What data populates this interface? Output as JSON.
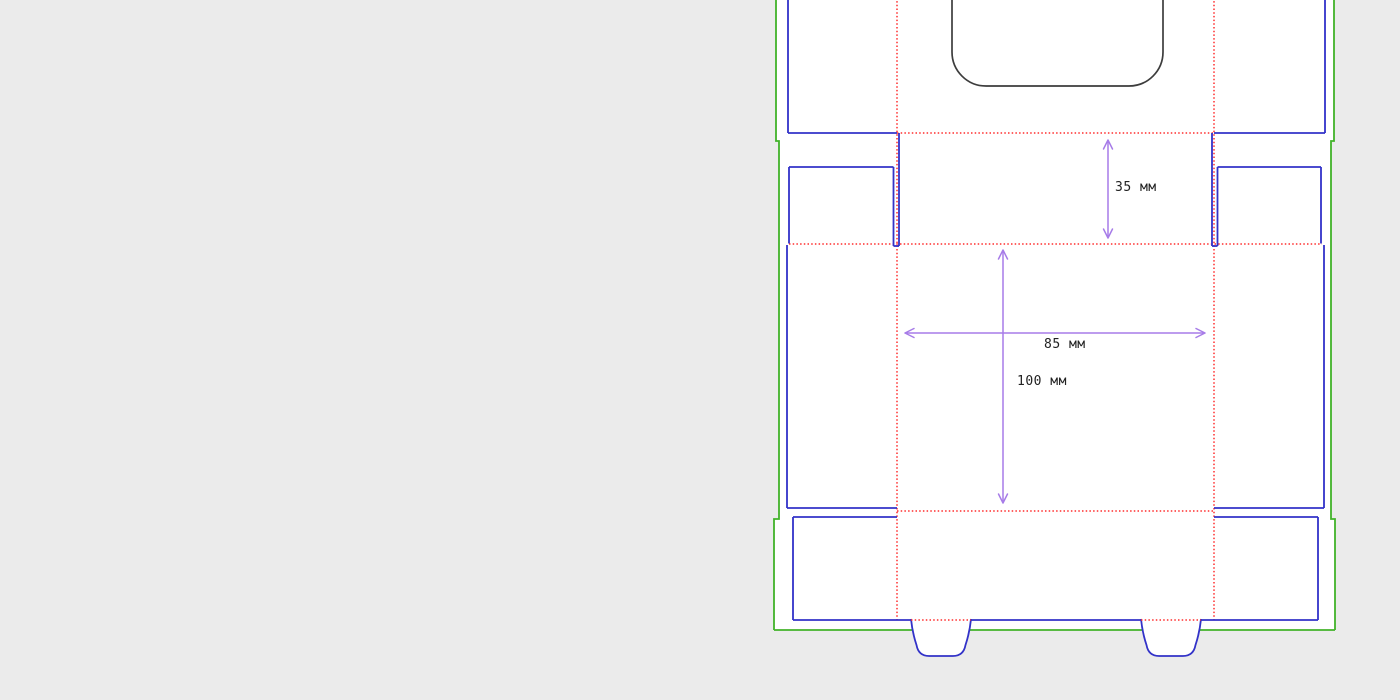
{
  "drawing": {
    "name": "box-dieline-technical-drawing",
    "dimension_labels": {
      "flap_height": "35 мм",
      "panel_width": "85 мм",
      "panel_height": "100 мм"
    },
    "dimensions": [
      {
        "id": "flap-height",
        "value": 35,
        "unit": "мм",
        "orientation": "vertical"
      },
      {
        "id": "panel-width",
        "value": 85,
        "unit": "мм",
        "orientation": "horizontal"
      },
      {
        "id": "panel-height",
        "value": 100,
        "unit": "мм",
        "orientation": "vertical"
      }
    ],
    "colors": {
      "background": "#ebebeb",
      "sheet_fill": "#ffffff",
      "cut_line": "#3232c8",
      "fold_line": "#ff2d2d",
      "outer_line": "#42b32a",
      "window_line": "#3d3d3d",
      "dimension_line": "#a77ce8",
      "label_text": "#222222"
    }
  }
}
